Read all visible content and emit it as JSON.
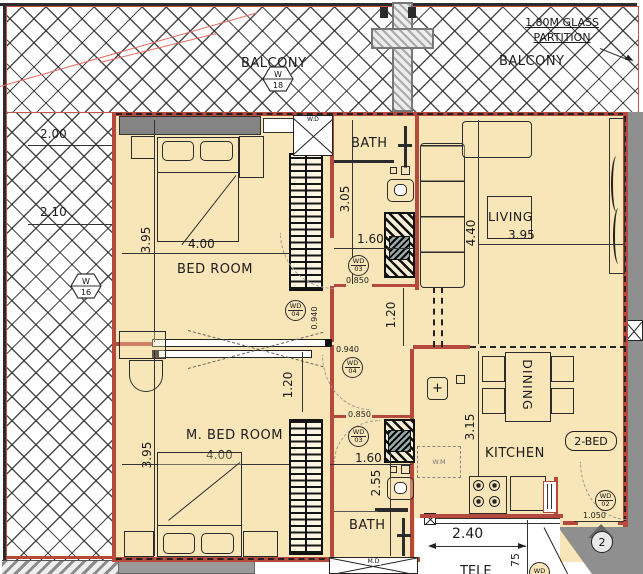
{
  "colors": {
    "floor": "#f8e6b8",
    "wall": "#b5493e",
    "outside": "#8f8f8f",
    "hatch_line": "#2d2d2d",
    "red_accent": "#e26a5f"
  },
  "balcony_top": {
    "label_left": "BALCONY",
    "label_right": "BALCONY",
    "note_line1": "1.80M GLASS",
    "note_line2": "PARTITION",
    "window_marker": {
      "letter": "W",
      "num": "18"
    }
  },
  "balcony_left": {
    "dim_top": "2.00",
    "dim_bottom": "2.10",
    "window_marker": {
      "letter": "W",
      "num": "16"
    }
  },
  "bedroom": {
    "label": "BED ROOM",
    "dim_width": "4.00",
    "dim_depth": "3.95"
  },
  "master_bedroom": {
    "label": "M. BED ROOM",
    "dim_width": "4.00",
    "dim_depth": "3.95"
  },
  "bath_top": {
    "label": "BATH",
    "dim_depth": "3.05",
    "dim_width": "1.60",
    "door_width": "0.850",
    "door_tag": {
      "code": "WD",
      "num": "03"
    }
  },
  "bath_bottom": {
    "label": "BATH",
    "dim_depth": "2.55",
    "dim_width": "1.60",
    "door_width": "0.850",
    "door_tag": {
      "code": "WD",
      "num": "03"
    }
  },
  "living": {
    "label": "LIVING",
    "dim_depth": "4.40",
    "dim_width": "3.95"
  },
  "dining": {
    "label": "DINING"
  },
  "kitchen": {
    "label": "KITCHEN",
    "dim_depth": "3.15",
    "washing_machine": "W.M",
    "db_marker": "+"
  },
  "corridor": {
    "dim_width_a": "1.20",
    "dim_width_b": "1.20",
    "clear_a": "0.940",
    "clear_b": "0.940",
    "door_tag_a": {
      "code": "WD",
      "num": "04"
    },
    "door_tag_b": {
      "code": "WD",
      "num": "04"
    }
  },
  "entry": {
    "badge": "2-BED",
    "door_width": "1.050",
    "door_tag": {
      "code": "WD",
      "num": "02"
    },
    "unit_number": "2"
  },
  "ducts": {
    "wd_label": "W.D",
    "md_label": "M.D"
  },
  "lobby": {
    "dim_width": "2.40",
    "dim_depth": "75",
    "tele_label": "TELE"
  }
}
